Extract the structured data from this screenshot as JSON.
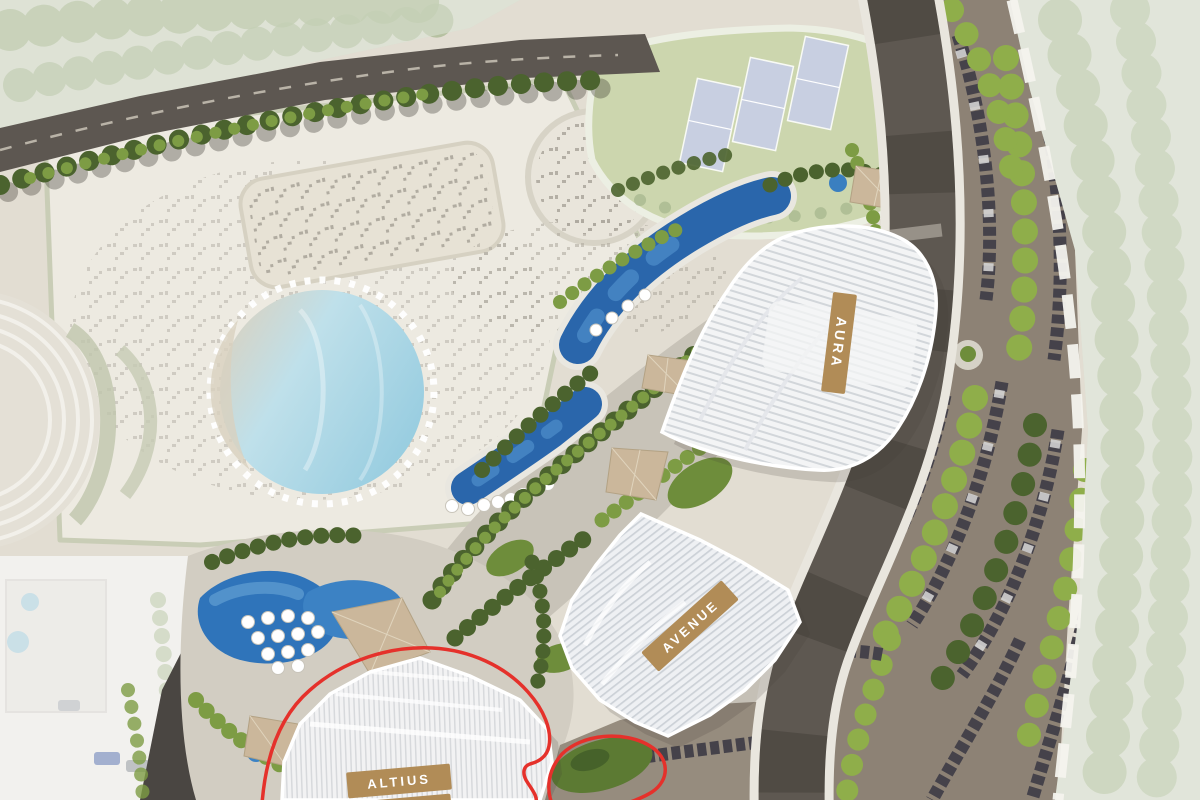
{
  "plan": {
    "buildings": [
      {
        "id": "aura",
        "label": "AURA"
      },
      {
        "id": "avenue",
        "label": "AVENUE"
      },
      {
        "id": "altius",
        "label": "ALTIUS",
        "highlighted": true
      }
    ],
    "label_style": {
      "bg": "#b18c57",
      "text": "#ffffff"
    },
    "boundary": {
      "color": "#e5312b"
    },
    "tennis_court_count": 3,
    "colors": {
      "deep_pool": "#2c6cb0",
      "lagoon": "#abd7e5",
      "lawn": "#ccd6ae",
      "court": "#c8cfe9",
      "road": "#57524c",
      "parking": "#8d8275",
      "tree_dark": "#4b632e",
      "tree_light": "#7d9c44"
    }
  }
}
